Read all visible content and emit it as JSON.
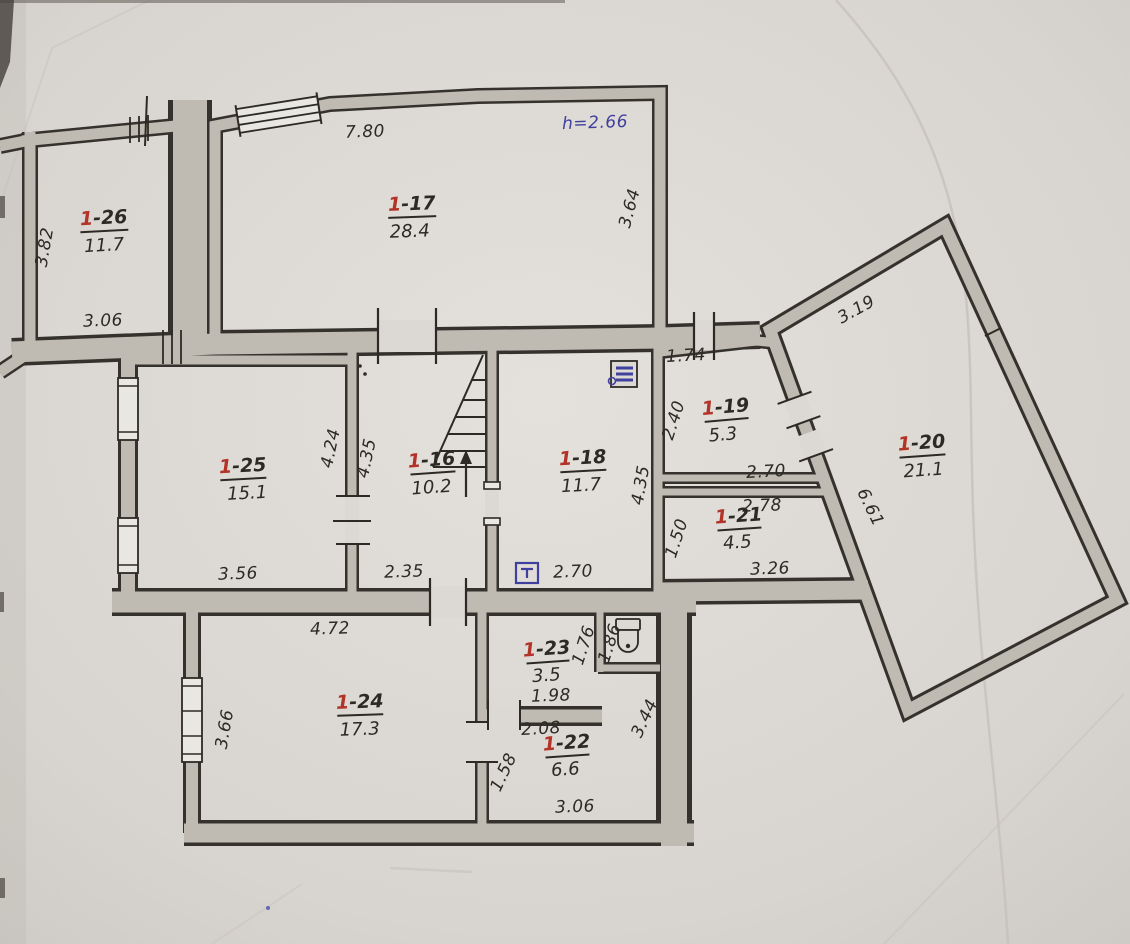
{
  "meta": {
    "document_type": "hand-drawn floor plan (scanned photo)",
    "height_note": "h=2.66"
  },
  "colors": {
    "paper": "#d8d4cf",
    "pencil_wall": "#bfbbb2",
    "ink": "#2d2a26",
    "room_number_red": "#b23327",
    "annotation_blue": "#3f3f9e"
  },
  "icons": {
    "toilet": "toilet-icon",
    "electrical_panel": "electrical-panel-icon",
    "fixture": "fixture-icon",
    "stairs": "staircase-up-arrow"
  },
  "rooms": [
    {
      "num": "1",
      "suffix": "-26",
      "area": "11.7"
    },
    {
      "num": "1",
      "suffix": "-17",
      "area": "28.4"
    },
    {
      "num": "1",
      "suffix": "-25",
      "area": "15.1"
    },
    {
      "num": "1",
      "suffix": "-16",
      "area": "10.2"
    },
    {
      "num": "1",
      "suffix": "-18",
      "area": "11.7"
    },
    {
      "num": "1",
      "suffix": "-19",
      "area": "5.3"
    },
    {
      "num": "1",
      "suffix": "-21",
      "area": "4.5"
    },
    {
      "num": "1",
      "suffix": "-20",
      "area": "21.1"
    },
    {
      "num": "1",
      "suffix": "-24",
      "area": "17.3"
    },
    {
      "num": "1",
      "suffix": "-23",
      "area": "3.5"
    },
    {
      "num": "1",
      "suffix": "-22",
      "area": "6.6"
    }
  ],
  "dims": {
    "d382": "3.82",
    "d306a": "3.06",
    "d780": "7.80",
    "h266": "h=2.66",
    "d364": "3.64",
    "d424": "4.24",
    "d435a": "4.35",
    "d356": "3.56",
    "d235": "2.35",
    "d270a": "2.70",
    "d435b": "4.35",
    "d174": "1.74",
    "d240": "2.40",
    "d270b": "2.70",
    "d278": "2.78",
    "d150": "1.50",
    "d326": "3.26",
    "d319": "3.19",
    "d661": "6.61",
    "d472": "4.72",
    "d366": "3.66",
    "d176": "1.76",
    "d198": "1.98",
    "d186": "1.86",
    "d208": "2.08",
    "d158": "1.58",
    "d344": "3.44",
    "d306b": "3.06"
  }
}
